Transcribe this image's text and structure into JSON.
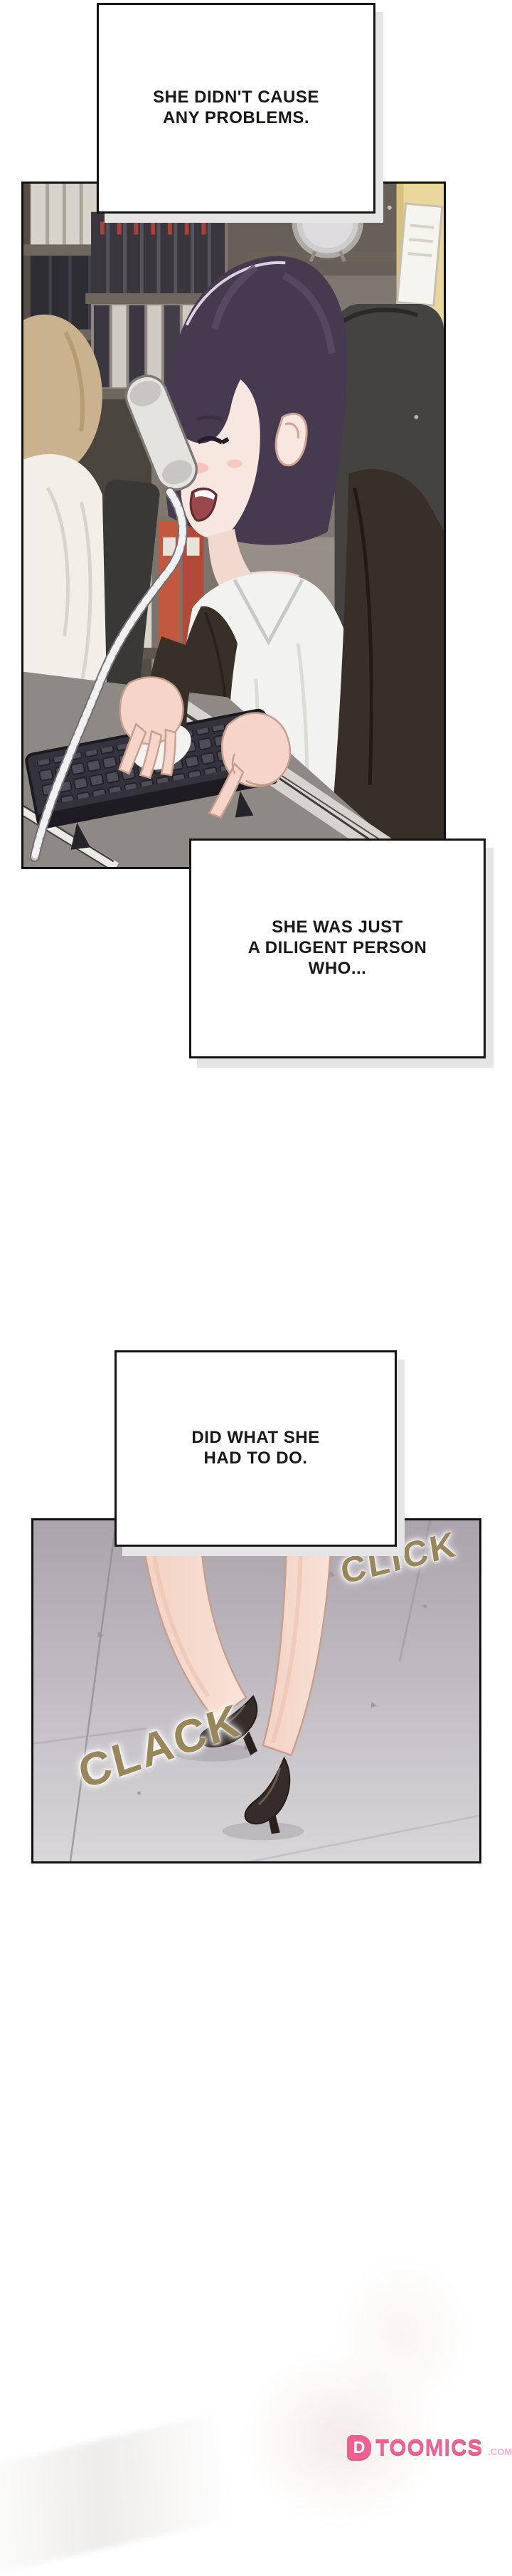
{
  "speech_boxes": [
    {
      "lines": [
        "SHE DIDN'T CAUSE",
        "ANY PROBLEMS."
      ]
    },
    {
      "lines": [
        "SHE WAS JUST",
        "A DILIGENT PERSON",
        "WHO..."
      ]
    },
    {
      "lines": [
        "DID WHAT SHE",
        "HAD TO DO."
      ]
    }
  ],
  "sfx": [
    {
      "text": "CLICK"
    },
    {
      "text": "CLACK"
    }
  ],
  "watermark": {
    "icon_letter": "D",
    "brand": "TOOMICS",
    "suffix": ".COM"
  },
  "colors": {
    "background": "#ffffff",
    "panel_border": "#111111",
    "speech_text": "#1a1816",
    "box_shadow": "#e5e5e5",
    "sfx_gold": "#97875a",
    "brand_pink": "#f0558c",
    "brand_pink_light": "#f5a9c6",
    "floor_top": "#aaa3ac",
    "floor_bottom": "#d8d6d9",
    "hair_purple": "#463a50",
    "suit_dark": "#382f29",
    "shoe_black": "#362d2a"
  }
}
